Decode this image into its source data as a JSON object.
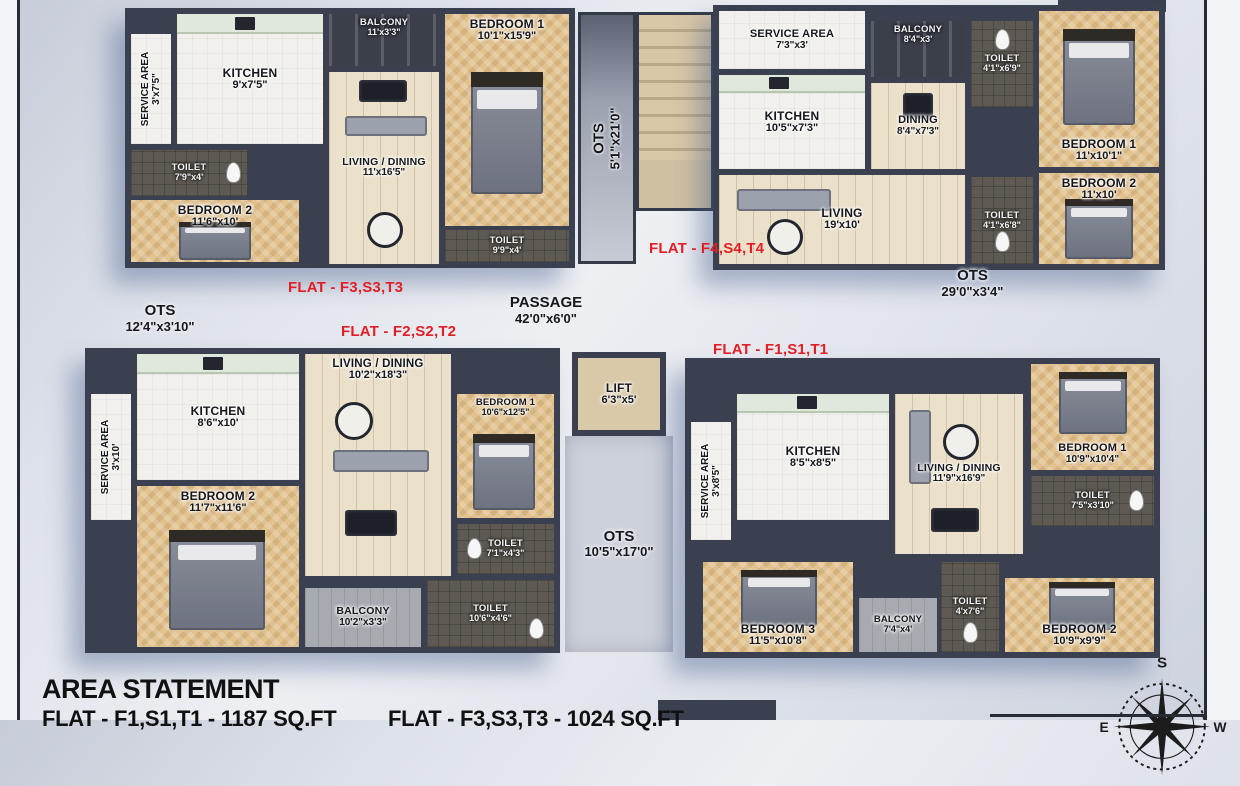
{
  "colors": {
    "flat_label_red": "#e31e24",
    "wall": "#3a4050",
    "floor_tan": "#e2c28d",
    "floor_wood": "#ebe0ca",
    "floor_dark": "#5e5a53",
    "page_bg": "#dde1e9"
  },
  "flats": {
    "f3": {
      "label": "FLAT - F3,S3,T3",
      "rooms": {
        "service": {
          "name": "SERVICE AREA",
          "dims": "3'x7'5\""
        },
        "kitchen": {
          "name": "KITCHEN",
          "dims": "9'x7'5\""
        },
        "balcony": {
          "name": "BALCONY",
          "dims": "11'x3'3\""
        },
        "bedroom1": {
          "name": "BEDROOM 1",
          "dims": "10'1\"x15'9\""
        },
        "toilet1": {
          "name": "TOILET",
          "dims": "7'9\"x4'"
        },
        "bedroom2": {
          "name": "BEDROOM 2",
          "dims": "11'6\"x10'"
        },
        "living": {
          "name": "LIVING / DINING",
          "dims": "11'x16'5\""
        },
        "toilet2": {
          "name": "TOILET",
          "dims": "9'9\"x4'"
        }
      }
    },
    "f4": {
      "label": "FLAT - F4,S4,T4",
      "rooms": {
        "service": {
          "name": "SERVICE AREA",
          "dims": "7'3\"x3'"
        },
        "balcony": {
          "name": "BALCONY",
          "dims": "8'4\"x3'"
        },
        "toilet1": {
          "name": "TOILET",
          "dims": "4'1\"x6'9\""
        },
        "bedroom1": {
          "name": "BEDROOM 1",
          "dims": "11'x10'1\""
        },
        "kitchen": {
          "name": "KITCHEN",
          "dims": "10'5\"x7'3\""
        },
        "dining": {
          "name": "DINING",
          "dims": "8'4\"x7'3\""
        },
        "living": {
          "name": "LIVING",
          "dims": "19'x10'"
        },
        "toilet2": {
          "name": "TOILET",
          "dims": "4'1\"x6'8\""
        },
        "bedroom2": {
          "name": "BEDROOM 2",
          "dims": "11'x10'"
        }
      }
    },
    "f2": {
      "label": "FLAT - F2,S2,T2",
      "rooms": {
        "service": {
          "name": "SERVICE AREA",
          "dims": "3'x10'"
        },
        "kitchen": {
          "name": "KITCHEN",
          "dims": "8'6\"x10'"
        },
        "living": {
          "name": "LIVING / DINING",
          "dims": "10'2\"x18'3\""
        },
        "bedroom1": {
          "name": "BEDROOM 1",
          "dims": "10'6\"x12'5\""
        },
        "bedroom2": {
          "name": "BEDROOM 2",
          "dims": "11'7\"x11'6\""
        },
        "toilet1": {
          "name": "TOILET",
          "dims": "7'1\"x4'3\""
        },
        "toilet2": {
          "name": "TOILET",
          "dims": "10'6\"x4'6\""
        },
        "balcony": {
          "name": "BALCONY",
          "dims": "10'2\"x3'3\""
        }
      }
    },
    "f1": {
      "label": "FLAT - F1,S1,T1",
      "rooms": {
        "service": {
          "name": "SERVICE AREA",
          "dims": "3'x8'5\""
        },
        "kitchen": {
          "name": "KITCHEN",
          "dims": "8'5\"x8'5\""
        },
        "living": {
          "name": "LIVING / DINING",
          "dims": "11'9\"x16'9\""
        },
        "bedroom1": {
          "name": "BEDROOM 1",
          "dims": "10'9\"x10'4\""
        },
        "toilet1": {
          "name": "TOILET",
          "dims": "7'5\"x3'10\""
        },
        "bedroom3": {
          "name": "BEDROOM 3",
          "dims": "11'5\"x10'8\""
        },
        "balcony": {
          "name": "BALCONY",
          "dims": "7'4\"x4'"
        },
        "toilet2": {
          "name": "TOILET",
          "dims": "4'x7'6\""
        },
        "bedroom2": {
          "name": "BEDROOM 2",
          "dims": "10'9\"x9'9\""
        }
      }
    }
  },
  "common": {
    "ots_top": {
      "name": "OTS",
      "dims": "5'1\"x21'0\""
    },
    "ots_left": {
      "name": "OTS",
      "dims": "12'4\"x3'10\""
    },
    "ots_right": {
      "name": "OTS",
      "dims": "29'0\"x3'4\""
    },
    "ots_bottom": {
      "name": "OTS",
      "dims": "10'5\"x17'0\""
    },
    "passage": {
      "name": "PASSAGE",
      "dims": "42'0\"x6'0\""
    },
    "lift": {
      "name": "LIFT",
      "dims": "6'3\"x5'"
    }
  },
  "area_statement": {
    "title": "AREA STATEMENT",
    "lines": [
      "FLAT - F1,S1,T1 - 1187 SQ.FT",
      "FLAT - F3,S3,T3 - 1024 SQ.FT"
    ]
  },
  "compass": {
    "south": "S",
    "east": "E",
    "west": "W"
  }
}
